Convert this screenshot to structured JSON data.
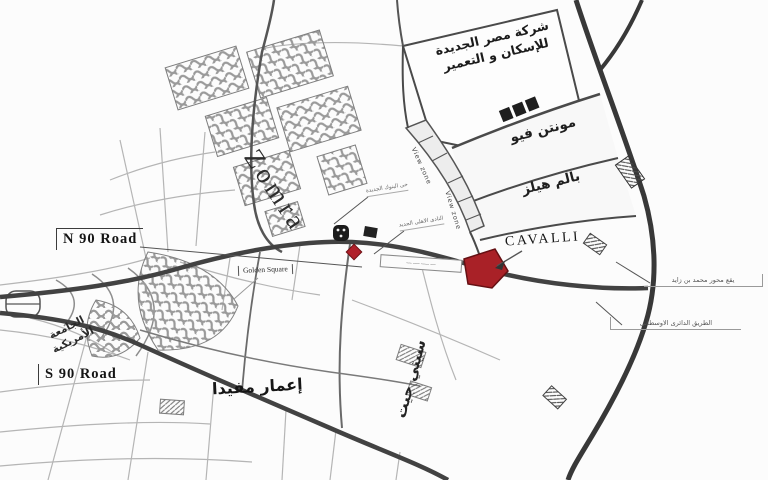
{
  "map": {
    "kind": "location-map",
    "labels": {
      "company_parcel": {
        "line1": "شركة مصر الجديدة",
        "line2": "للإسكان و التعمير"
      },
      "mountain_view": "مونتن فيو",
      "palm_hills": "بالم هيلز",
      "zomra": "Zomra",
      "view_zone_upper": "View zone",
      "view_zone_lower": "View zone",
      "cavalli": "CAVALLI",
      "n90_road": "N 90 Road",
      "s90_road": "S 90 Road",
      "golden_square": "Golden Square",
      "american_university": {
        "line1": "الجامعة",
        "line2": "الأمريكية"
      },
      "emaar_mivida": "إعمار مفيدا",
      "city_gate": "سيتي جيت",
      "mbz_axis_callout": "يقع محور محمد بن زايد",
      "middle_ring_road_callout": "الطريق الدائرى الاوسطانى",
      "small_callout_upper": "حى البنوك الجديدة",
      "small_callout_lower": "النادى الاهلى الجديد",
      "road_box_label": "ــــ ــــــ ـــــ ــــ"
    },
    "colors": {
      "cavalli_parcel": "#a92127",
      "red_diamond_logo": "#b0202a",
      "road_dark": "#3d3d3d",
      "paper": "#fcfcfc"
    },
    "icons": {
      "dark_landmark_logo": "dark-landmark-logo-icon",
      "red_diamond_logo": "red-diamond-logo-icon",
      "cavalli_leader": "leader-arrow-icon",
      "interchange": "trumpet-interchange-icon"
    }
  }
}
